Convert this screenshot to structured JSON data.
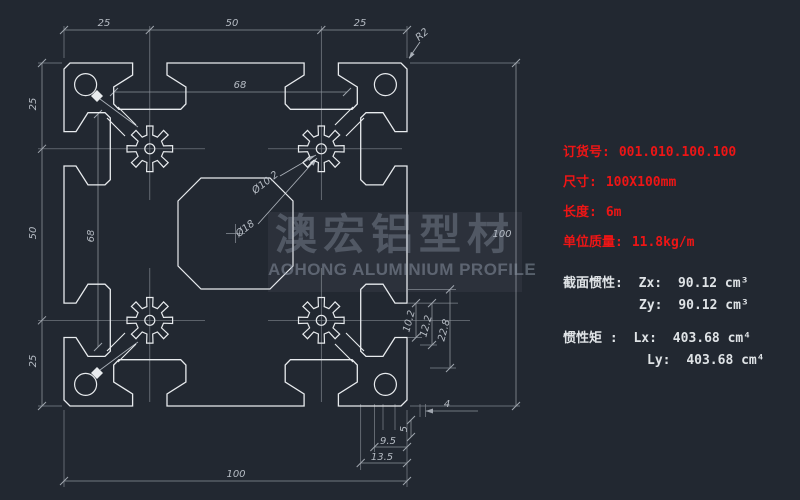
{
  "watermark": {
    "cn": "澳宏铝型材",
    "en": "AOHONG ALUMINIUM PROFILE"
  },
  "specs": {
    "rows": [
      {
        "label": "订货号:",
        "value": "001.010.100.100"
      },
      {
        "label": "尺寸:",
        "value": "100X100mm"
      },
      {
        "label": "长度:",
        "value": "6m"
      },
      {
        "label": "单位质量:",
        "value": "11.8kg/m"
      }
    ]
  },
  "props": {
    "section_label": "截面惯性:",
    "zx_label": "Zx:",
    "zx_value": "90.12 cm³",
    "zy_label": "Zy:",
    "zy_value": "90.12 cm³",
    "moment_label": "惯性矩 :",
    "lx_label": "Lx:",
    "lx_value": "403.68 cm⁴",
    "ly_label": "Ly:",
    "ly_value": "403.68 cm⁴"
  },
  "dims": {
    "top": [
      "25",
      "50",
      "25"
    ],
    "left": [
      "25",
      "50",
      "25"
    ],
    "right": "100",
    "bottom": "100",
    "fillet": "R2",
    "inner_h": "68",
    "inner_v": "68",
    "bore_small": "Ø10.2",
    "bore_large": "Ø18",
    "slot_right": [
      "10.2",
      "12.2",
      "22.8"
    ],
    "slot_bottom": [
      "13.5",
      "9.5",
      "5",
      "4"
    ]
  }
}
